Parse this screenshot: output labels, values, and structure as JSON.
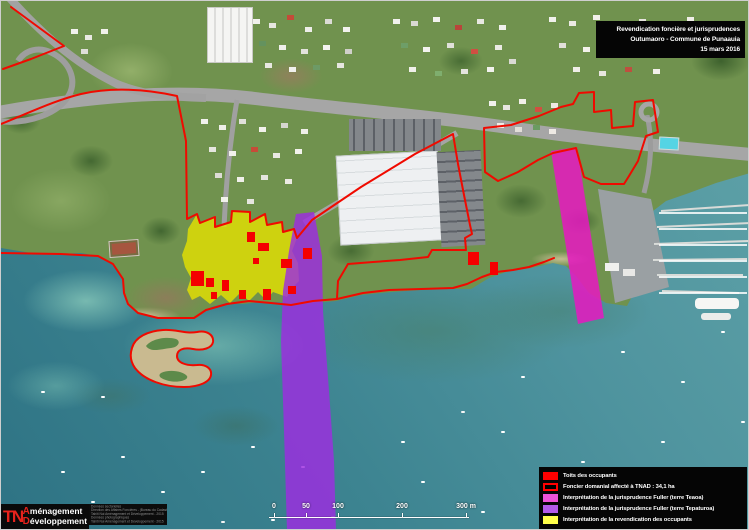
{
  "title_box": {
    "line1": "Revendication foncière et jurisprudences",
    "line2": "Outumaoro - Commune de Punaauia",
    "line3": "15 mars 2016"
  },
  "legend": {
    "items": [
      {
        "label": "Toits des occupants",
        "swatch": "#ff0000",
        "style": "fill"
      },
      {
        "label": "Foncier domanial affecté à TNAD : 34,1 ha",
        "swatch": "#ff0000",
        "style": "outline"
      },
      {
        "label": "Interprétation de la jurisprudence Fuller (terre Teaoa)",
        "swatch": "#ee52d8",
        "style": "fill"
      },
      {
        "label": "Interprétation de la jurisprudence Fuller (terre Tepaturoa)",
        "swatch": "#b35ae8",
        "style": "fill"
      },
      {
        "label": "Interprétation de la revendication des occupants",
        "swatch": "#ffff4a",
        "style": "fill"
      }
    ]
  },
  "scale_bar": {
    "unit": "m",
    "ticks": [
      {
        "label": "0",
        "x": 273
      },
      {
        "label": "50",
        "x": 305
      },
      {
        "label": "100",
        "x": 337
      },
      {
        "label": "200",
        "x": 401
      },
      {
        "label": "300 m",
        "x": 465
      }
    ]
  },
  "logo": {
    "tn": "TN",
    "initial1": "A",
    "word1": "ménagement",
    "initial2": "D",
    "word2": "éveloppement"
  },
  "credits": {
    "lines": [
      "Données sectorielles",
      "Direction des Affaires Foncières - (Bureau du Cadastre) - 2015",
      "Tahiti Nui Aménagement et Développement - 2015",
      "Données photographiques",
      "Tahiti Nui Aménagement et Développement - 2015"
    ]
  },
  "colors": {
    "boundary_red": "#f00a00",
    "roof_red": "#f50000",
    "overlay_yellow": "#e6e200",
    "overlay_purple": "#9e2ce0",
    "overlay_magenta": "#e818c2",
    "water_deep": "#2e7384",
    "water_shallow": "#7fc0b4",
    "land_green": "#70924e"
  },
  "map": {
    "occupant_roofs": [
      [
        190,
        270,
        13,
        15
      ],
      [
        205,
        277,
        8,
        9
      ],
      [
        221,
        279,
        7,
        11
      ],
      [
        210,
        291,
        6,
        7
      ],
      [
        246,
        231,
        8,
        10
      ],
      [
        257,
        242,
        11,
        8
      ],
      [
        252,
        257,
        6,
        6
      ],
      [
        262,
        288,
        8,
        11
      ],
      [
        280,
        258,
        11,
        9
      ],
      [
        302,
        247,
        9,
        11
      ],
      [
        287,
        285,
        8,
        8
      ],
      [
        238,
        289,
        7,
        9
      ],
      [
        467,
        251,
        11,
        13
      ],
      [
        489,
        261,
        8,
        13
      ]
    ]
  }
}
